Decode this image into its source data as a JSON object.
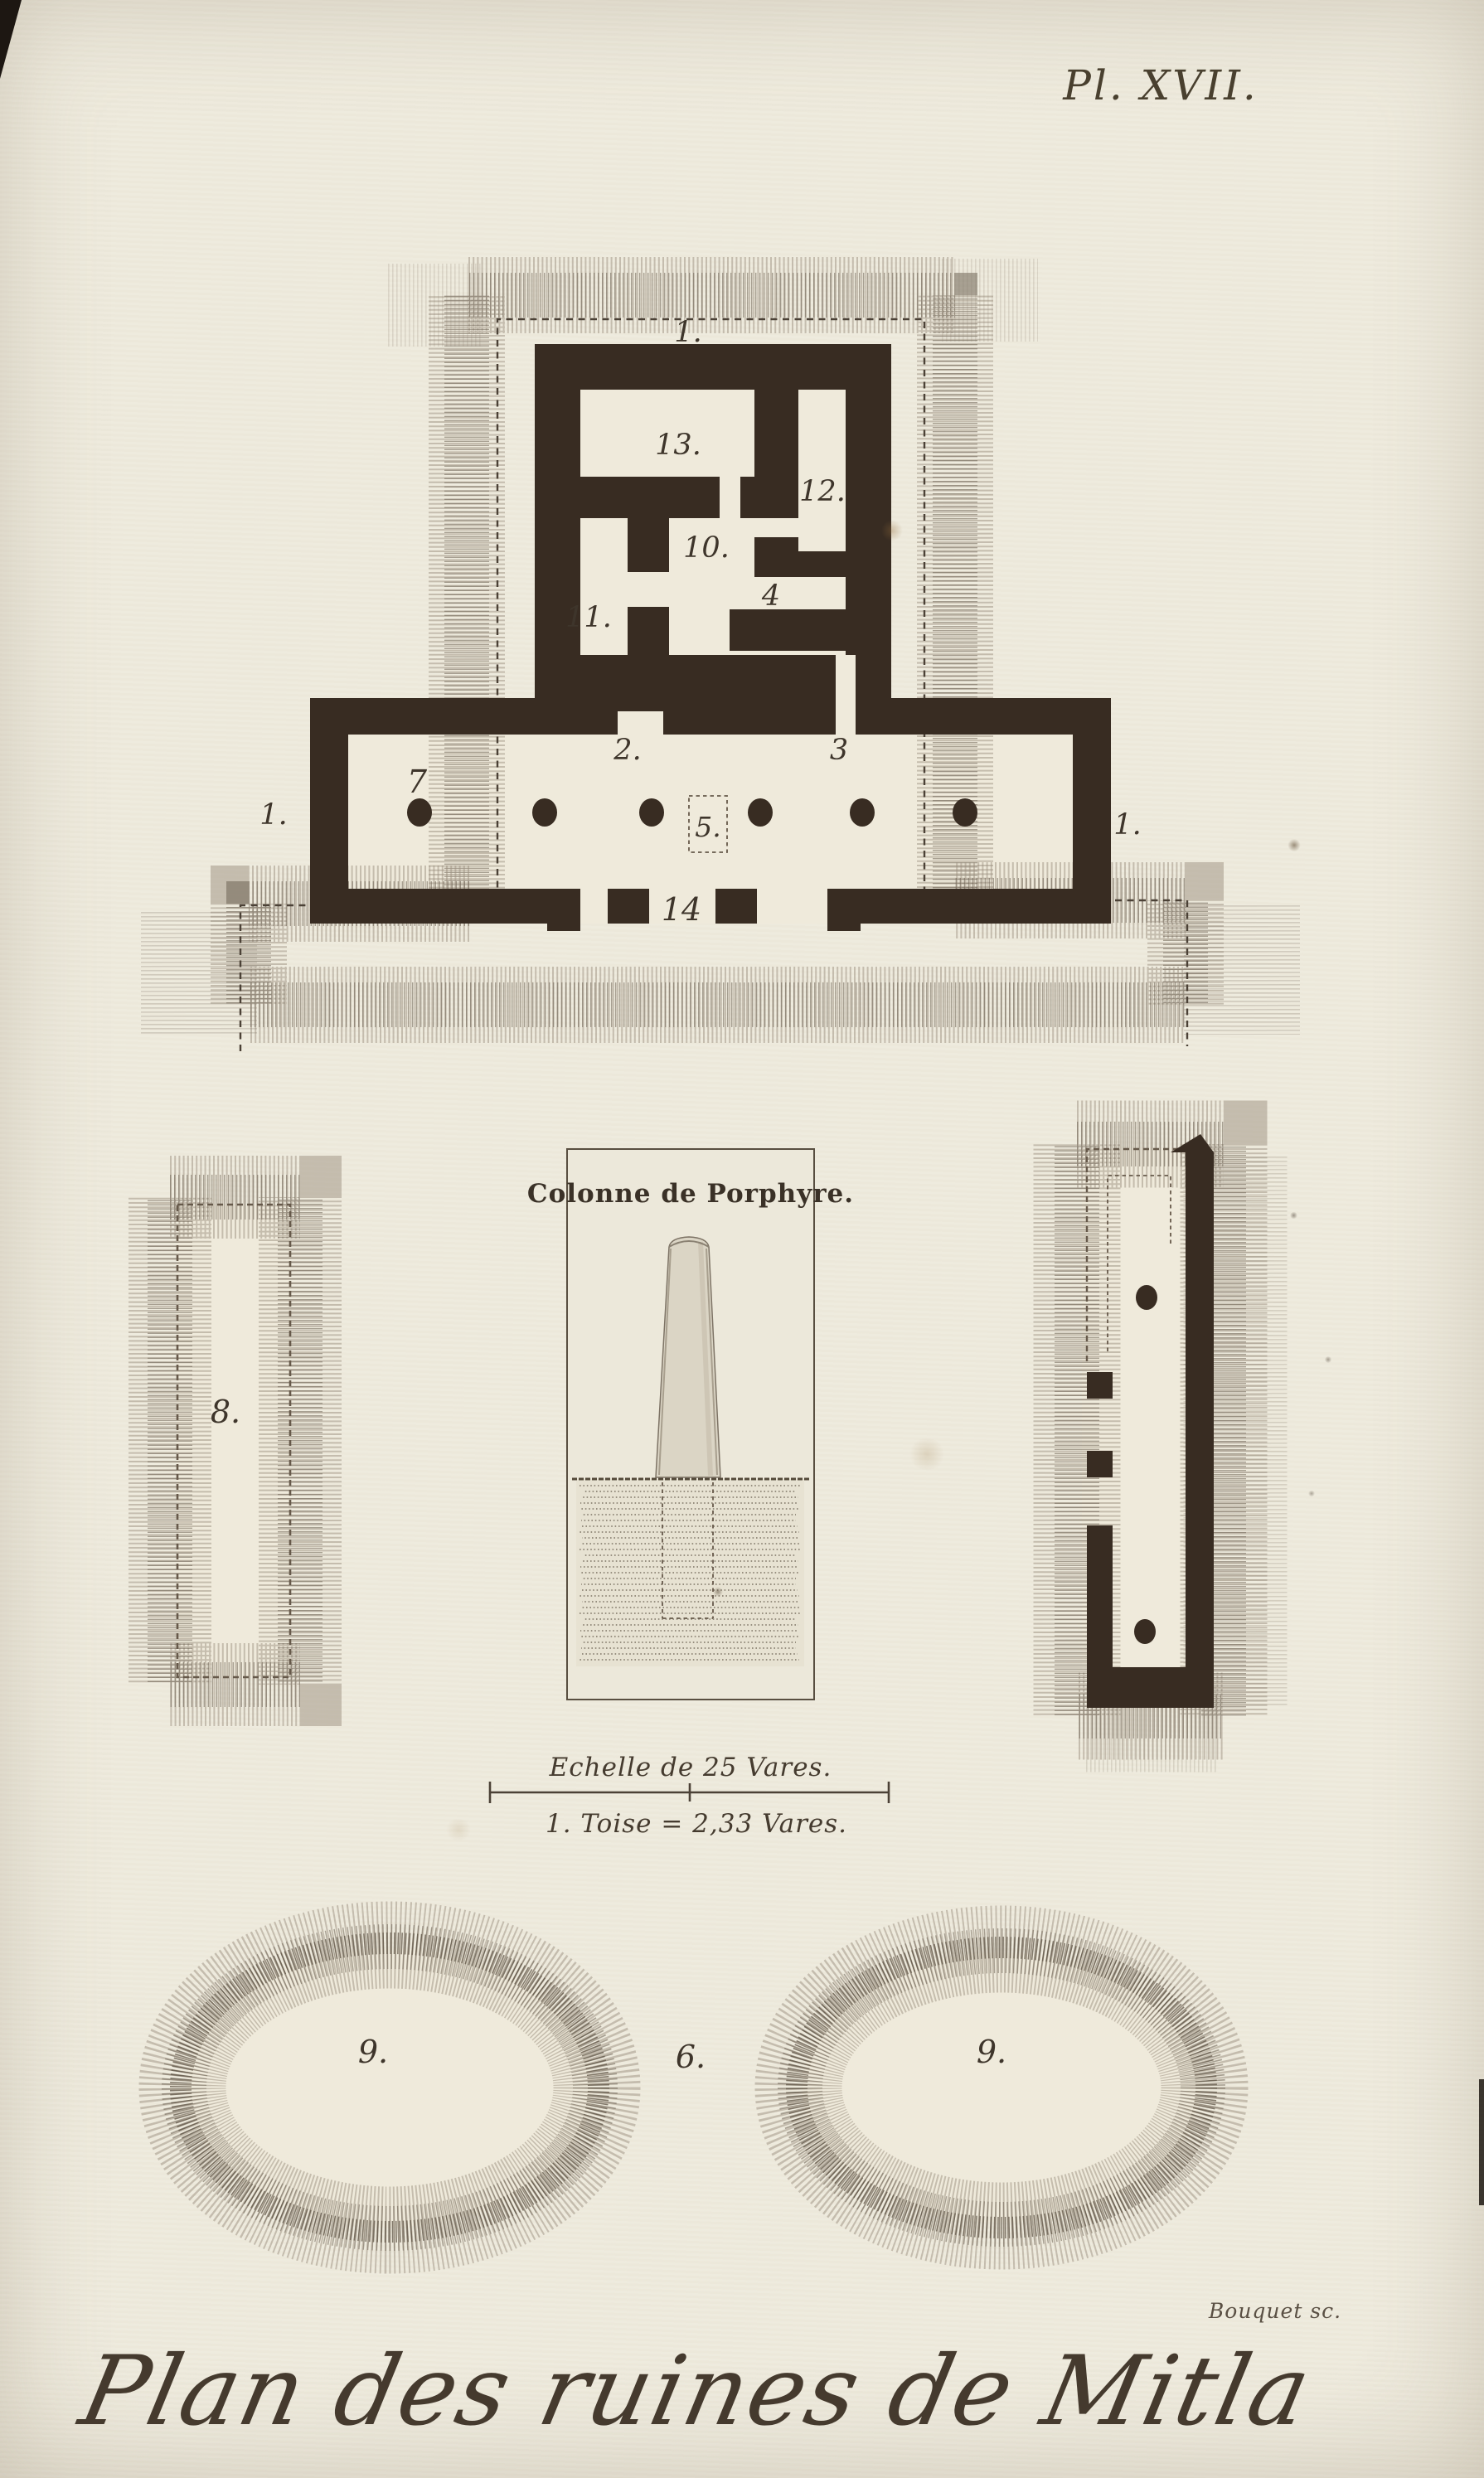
{
  "plate": {
    "number": "Pl. XVII.",
    "title": "Plan des ruines de Mitla",
    "engraver": "Bouquet sc."
  },
  "column_figure": {
    "title": "Colonne de Porphyre."
  },
  "scale_bar": {
    "caption": "Echelle de 25 Vares.",
    "conversion": "1. Toise = 2,33 Vares."
  },
  "main_plan": {
    "labels": {
      "terrace_top": "1.",
      "room_13": "13.",
      "room_12": "12.",
      "room_10": "10.",
      "room_11": "11.",
      "room_4": "4",
      "door_2": "2.",
      "door_3": "3",
      "column_7": "7",
      "altar_5": "5.",
      "terrace_left": "1.",
      "terrace_right": "1.",
      "door_14": "14"
    }
  },
  "site_features": {
    "mound_8": "8.",
    "mound_9_left": "9.",
    "mound_6": "6.",
    "mound_9_right": "9."
  },
  "colors": {
    "paper": "#e9e4d4",
    "ink": "#3e352b",
    "wall": "#382c22",
    "hatch": "#8d8272"
  }
}
